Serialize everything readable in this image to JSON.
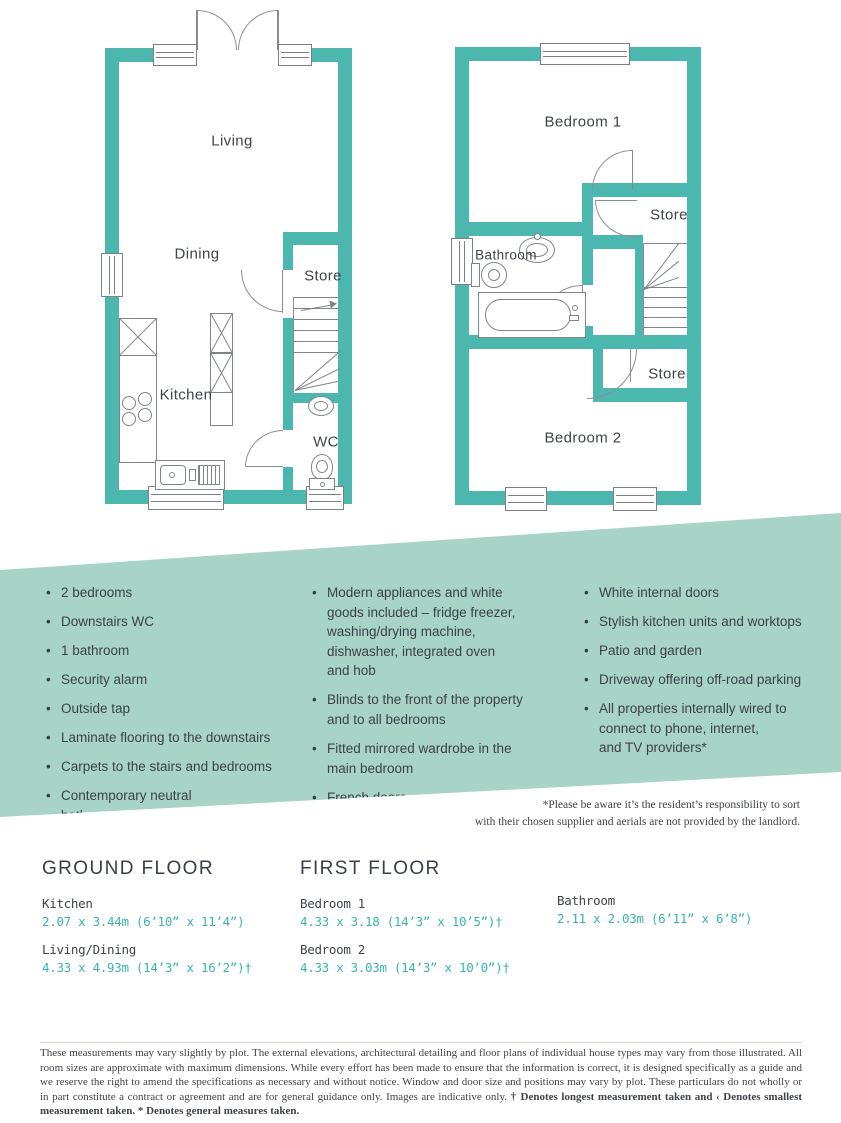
{
  "palette": {
    "wall_teal": "#4cb7ae",
    "banner_teal": "#a8d3c7",
    "measure_teal": "#3bb5ac",
    "text_dark": "#3c4149"
  },
  "floorplans": {
    "ground": {
      "living": "Living",
      "dining": "Dining",
      "store": "Store",
      "kitchen": "Kitchen",
      "wc": "WC"
    },
    "first": {
      "bedroom1": "Bedroom 1",
      "store_upper": "Store",
      "bathroom": "Bathroom",
      "store_lower": "Store",
      "bedroom2": "Bedroom 2"
    }
  },
  "features": {
    "col1": [
      "2 bedrooms",
      "Downstairs WC",
      "1 bathroom",
      "Security alarm",
      "Outside tap",
      "Laminate flooring to the downstairs",
      "Carpets to the stairs and bedrooms",
      "Contemporary neutral\nbathroom suite"
    ],
    "col2": [
      "Modern appliances and white\ngoods included – fridge freezer,\nwashing/drying machine,\ndishwasher, integrated oven\nand hob",
      "Blinds to the front of the property\nand to all bedrooms",
      "Fitted mirrored wardrobe in the\nmain bedroom",
      "French doors"
    ],
    "col3": [
      "White internal doors",
      "Stylish kitchen units and worktops",
      "Patio and garden",
      "Driveway offering off-road parking",
      "All properties internally wired to\nconnect to phone, internet,\nand TV providers*"
    ]
  },
  "aerials_note": {
    "line1": "*Please be aware it’s the resident’s responsibility to sort",
    "line2": "with their chosen supplier and aerials are not provided by the landlord."
  },
  "measurements": {
    "ground": {
      "title": "GROUND FLOOR",
      "rooms": [
        {
          "name": "Kitchen",
          "dims": "2.07 x 3.44m (6’10” x 11’4”)"
        },
        {
          "name": "Living/Dining",
          "dims": "4.33 x 4.93m (14’3” x 16’2”)†"
        }
      ]
    },
    "first": {
      "title": "FIRST FLOOR",
      "rooms": [
        {
          "name": "Bedroom 1",
          "dims": "4.33 x 3.18 (14’3” x 10’5”)†"
        },
        {
          "name": "Bedroom 2",
          "dims": "4.33 x 3.03m (14’3” x 10’0”)†"
        }
      ]
    },
    "other": {
      "rooms": [
        {
          "name": "Bathroom",
          "dims": "2.11 x 2.03m (6’11” x 6’8”)"
        }
      ]
    }
  },
  "disclaimer": {
    "main": "These measurements may vary slightly by plot. The external elevations, architectural detailing and floor plans of individual house types may vary from those illustrated. All room sizes are approximate with maximum dimensions. While every effort has been made to ensure that the information is correct, it is designed specifically as a guide and we reserve the right to amend the specifications as necessary and without notice. Window and door size and positions may vary by plot. These particulars do not wholly or in part constitute a contract or agreement and are for general guidance only. Images are indicative only. ",
    "bold": "† Denotes longest measurement taken and ‹ Denotes smallest measurement taken. * Denotes general measures taken."
  }
}
